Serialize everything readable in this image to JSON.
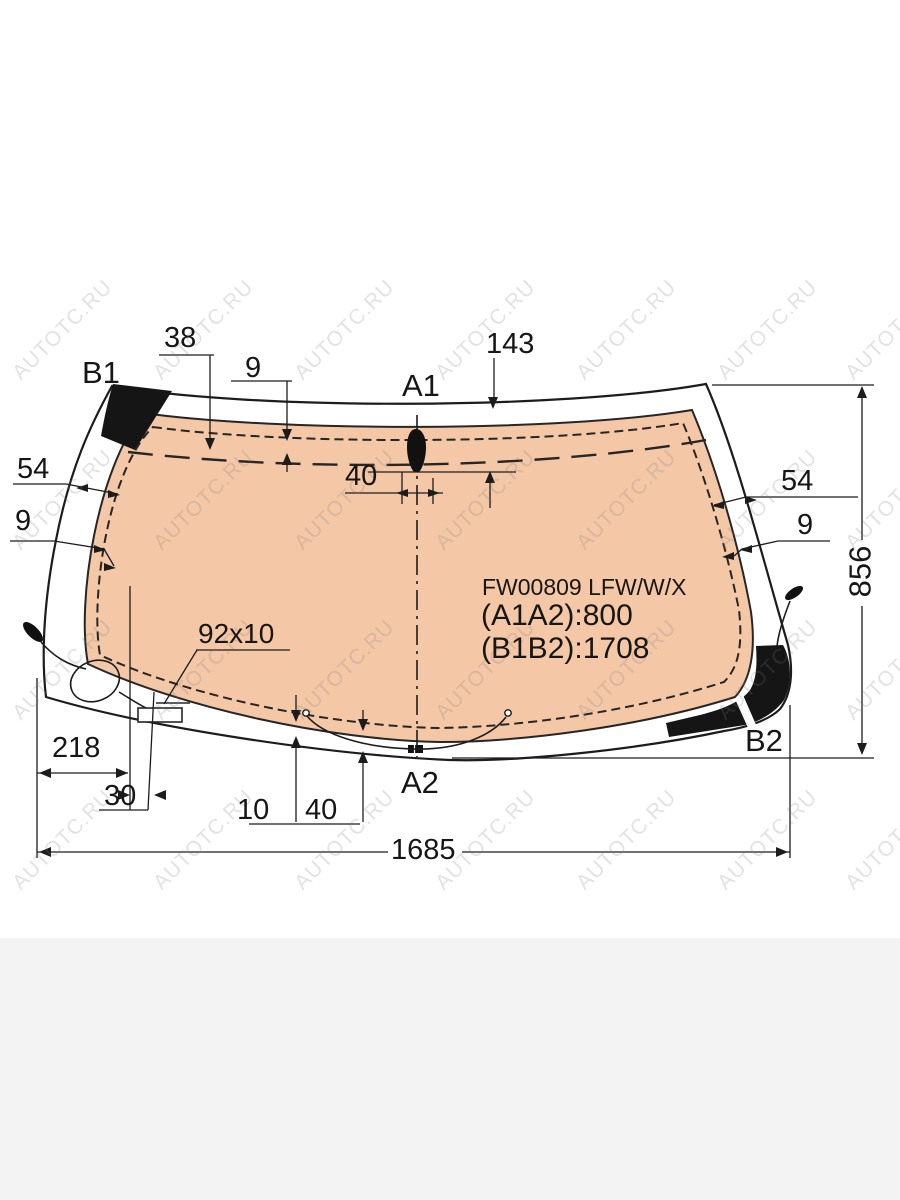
{
  "watermark": {
    "text": "AUTOTC.RU",
    "color": "rgba(125,125,125,0.22)",
    "cols": [
      25,
      166,
      307,
      448,
      589,
      730,
      858
    ],
    "rows": [
      288,
      458,
      628,
      798
    ]
  },
  "glass_info": {
    "part_code": "FW00809 LFW/W/X",
    "a1a2": "(A1A2):800",
    "b1b2": "(B1B2):1708"
  },
  "corner_labels": {
    "b1": "B1",
    "a1": "A1",
    "a2": "A2",
    "b2": "B2"
  },
  "dimensions": {
    "top_offset_38": "38",
    "top_gap_9": "9",
    "center_top_143": "143",
    "sensor_width_40": "40",
    "left_54": "54",
    "left_9": "9",
    "right_54": "54",
    "right_9": "9",
    "height_856": "856",
    "bottom_left_218": "218",
    "bottom_left_30": "30",
    "bracket_92x10": "92x10",
    "bottom_10": "10",
    "bottom_40": "40",
    "width_1685": "1685"
  },
  "colors": {
    "glass_tint": "#f4c7a6",
    "line": "#1c1c1c",
    "ceramic_patch": "#151515",
    "footer_band": "#f3f3f3"
  }
}
